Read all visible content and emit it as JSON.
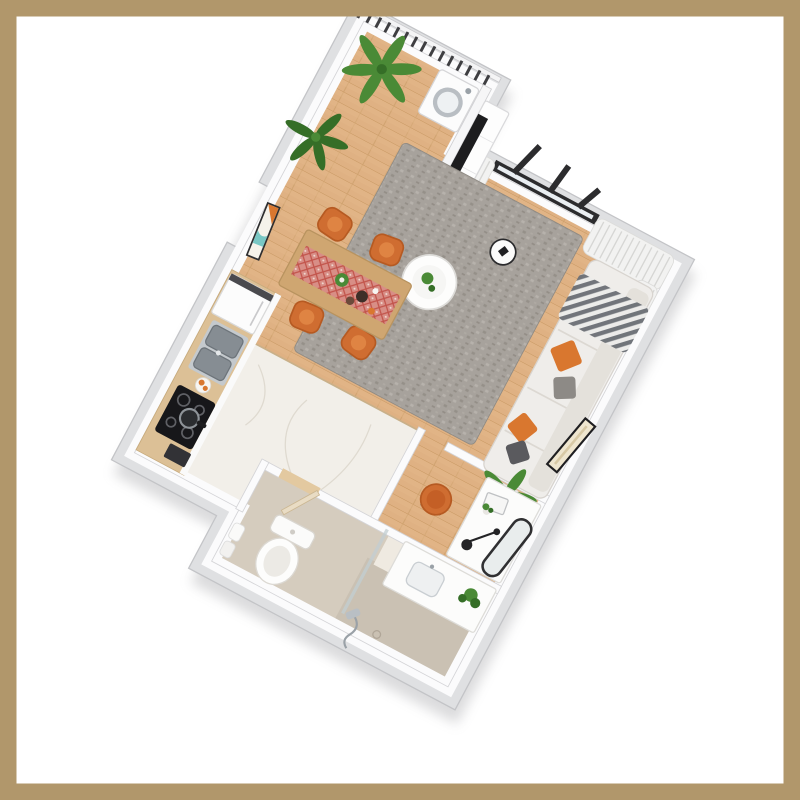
{
  "scene": {
    "type": "3d-floor-plan-render",
    "view": "rotated top-down dollhouse render of a studio apartment",
    "rooms": [
      "balcony-laundry-nook",
      "living-room",
      "dining-area",
      "kitchen",
      "hallway",
      "work-nook",
      "bathroom"
    ],
    "inventory": {
      "dining_chairs": 4,
      "desk_chairs": 1,
      "sofas": 1,
      "sofa_pillows": 5,
      "plants": 7,
      "wall_art": 2,
      "appliances": [
        "washing-machine",
        "tv",
        "fridge",
        "cooktop",
        "double-sink",
        "oven"
      ],
      "bathroom_fixtures": [
        "toilet",
        "vanity-sink",
        "hand-shower",
        "towels"
      ]
    }
  },
  "colors": {
    "frame": "#b1976b",
    "background": "#ffffff",
    "slab": "#dfe0e2",
    "wall": "#fbfbfc",
    "wood": "#dfb183",
    "marble": "#f2efe9",
    "tile": "#d5ccbe",
    "tileWet": "#c9c0b1",
    "rug": "#a7a29c",
    "sofa": "#efedea",
    "accentOrange": "#d9772f",
    "chairOrange": "#cf6d31",
    "plantGreen": "#4a8a36",
    "plantDark": "#356e27",
    "tableWood": "#cfa671",
    "runner": "#d88e86",
    "runnerPattern": "#c2544b",
    "tv": "#1d1d1f",
    "window": "#2c2c2e",
    "curtain": "#f2f2f1",
    "railing": "#3e3e41",
    "steel": "#9aa1a7",
    "navy": "#2e3a5c"
  }
}
